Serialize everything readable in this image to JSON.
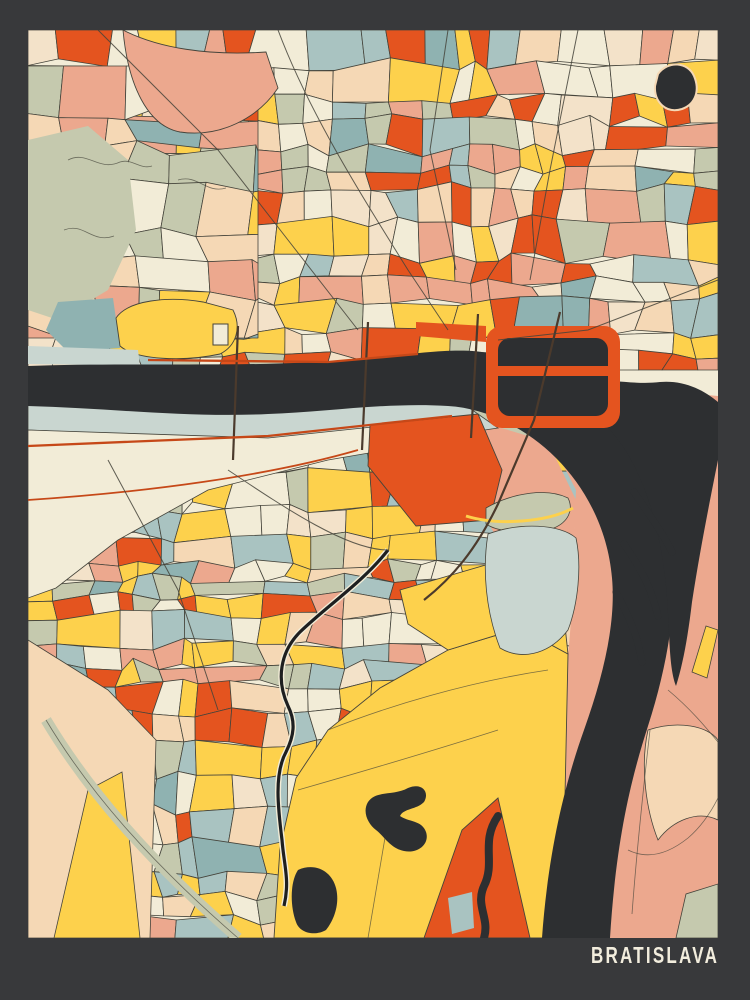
{
  "title": {
    "label": "BRATISLAVA"
  },
  "palette": {
    "frame": "#38393b",
    "water": "#2d2f31",
    "orange": "#e4541f",
    "orange_dark": "#c64818",
    "yellow": "#fdd14c",
    "salmon": "#eca88e",
    "peach": "#f5d8b5",
    "peach_light": "#f3e2c9",
    "cream": "#f2ecd7",
    "blue_pale": "#c9d6d0",
    "blue_gray": "#a9c3c1",
    "teal": "#8fb2b1",
    "sage": "#c5c9ae",
    "outline": "#45443b",
    "road_black": "#1e1f20",
    "title_text": "#f2eddd"
  }
}
